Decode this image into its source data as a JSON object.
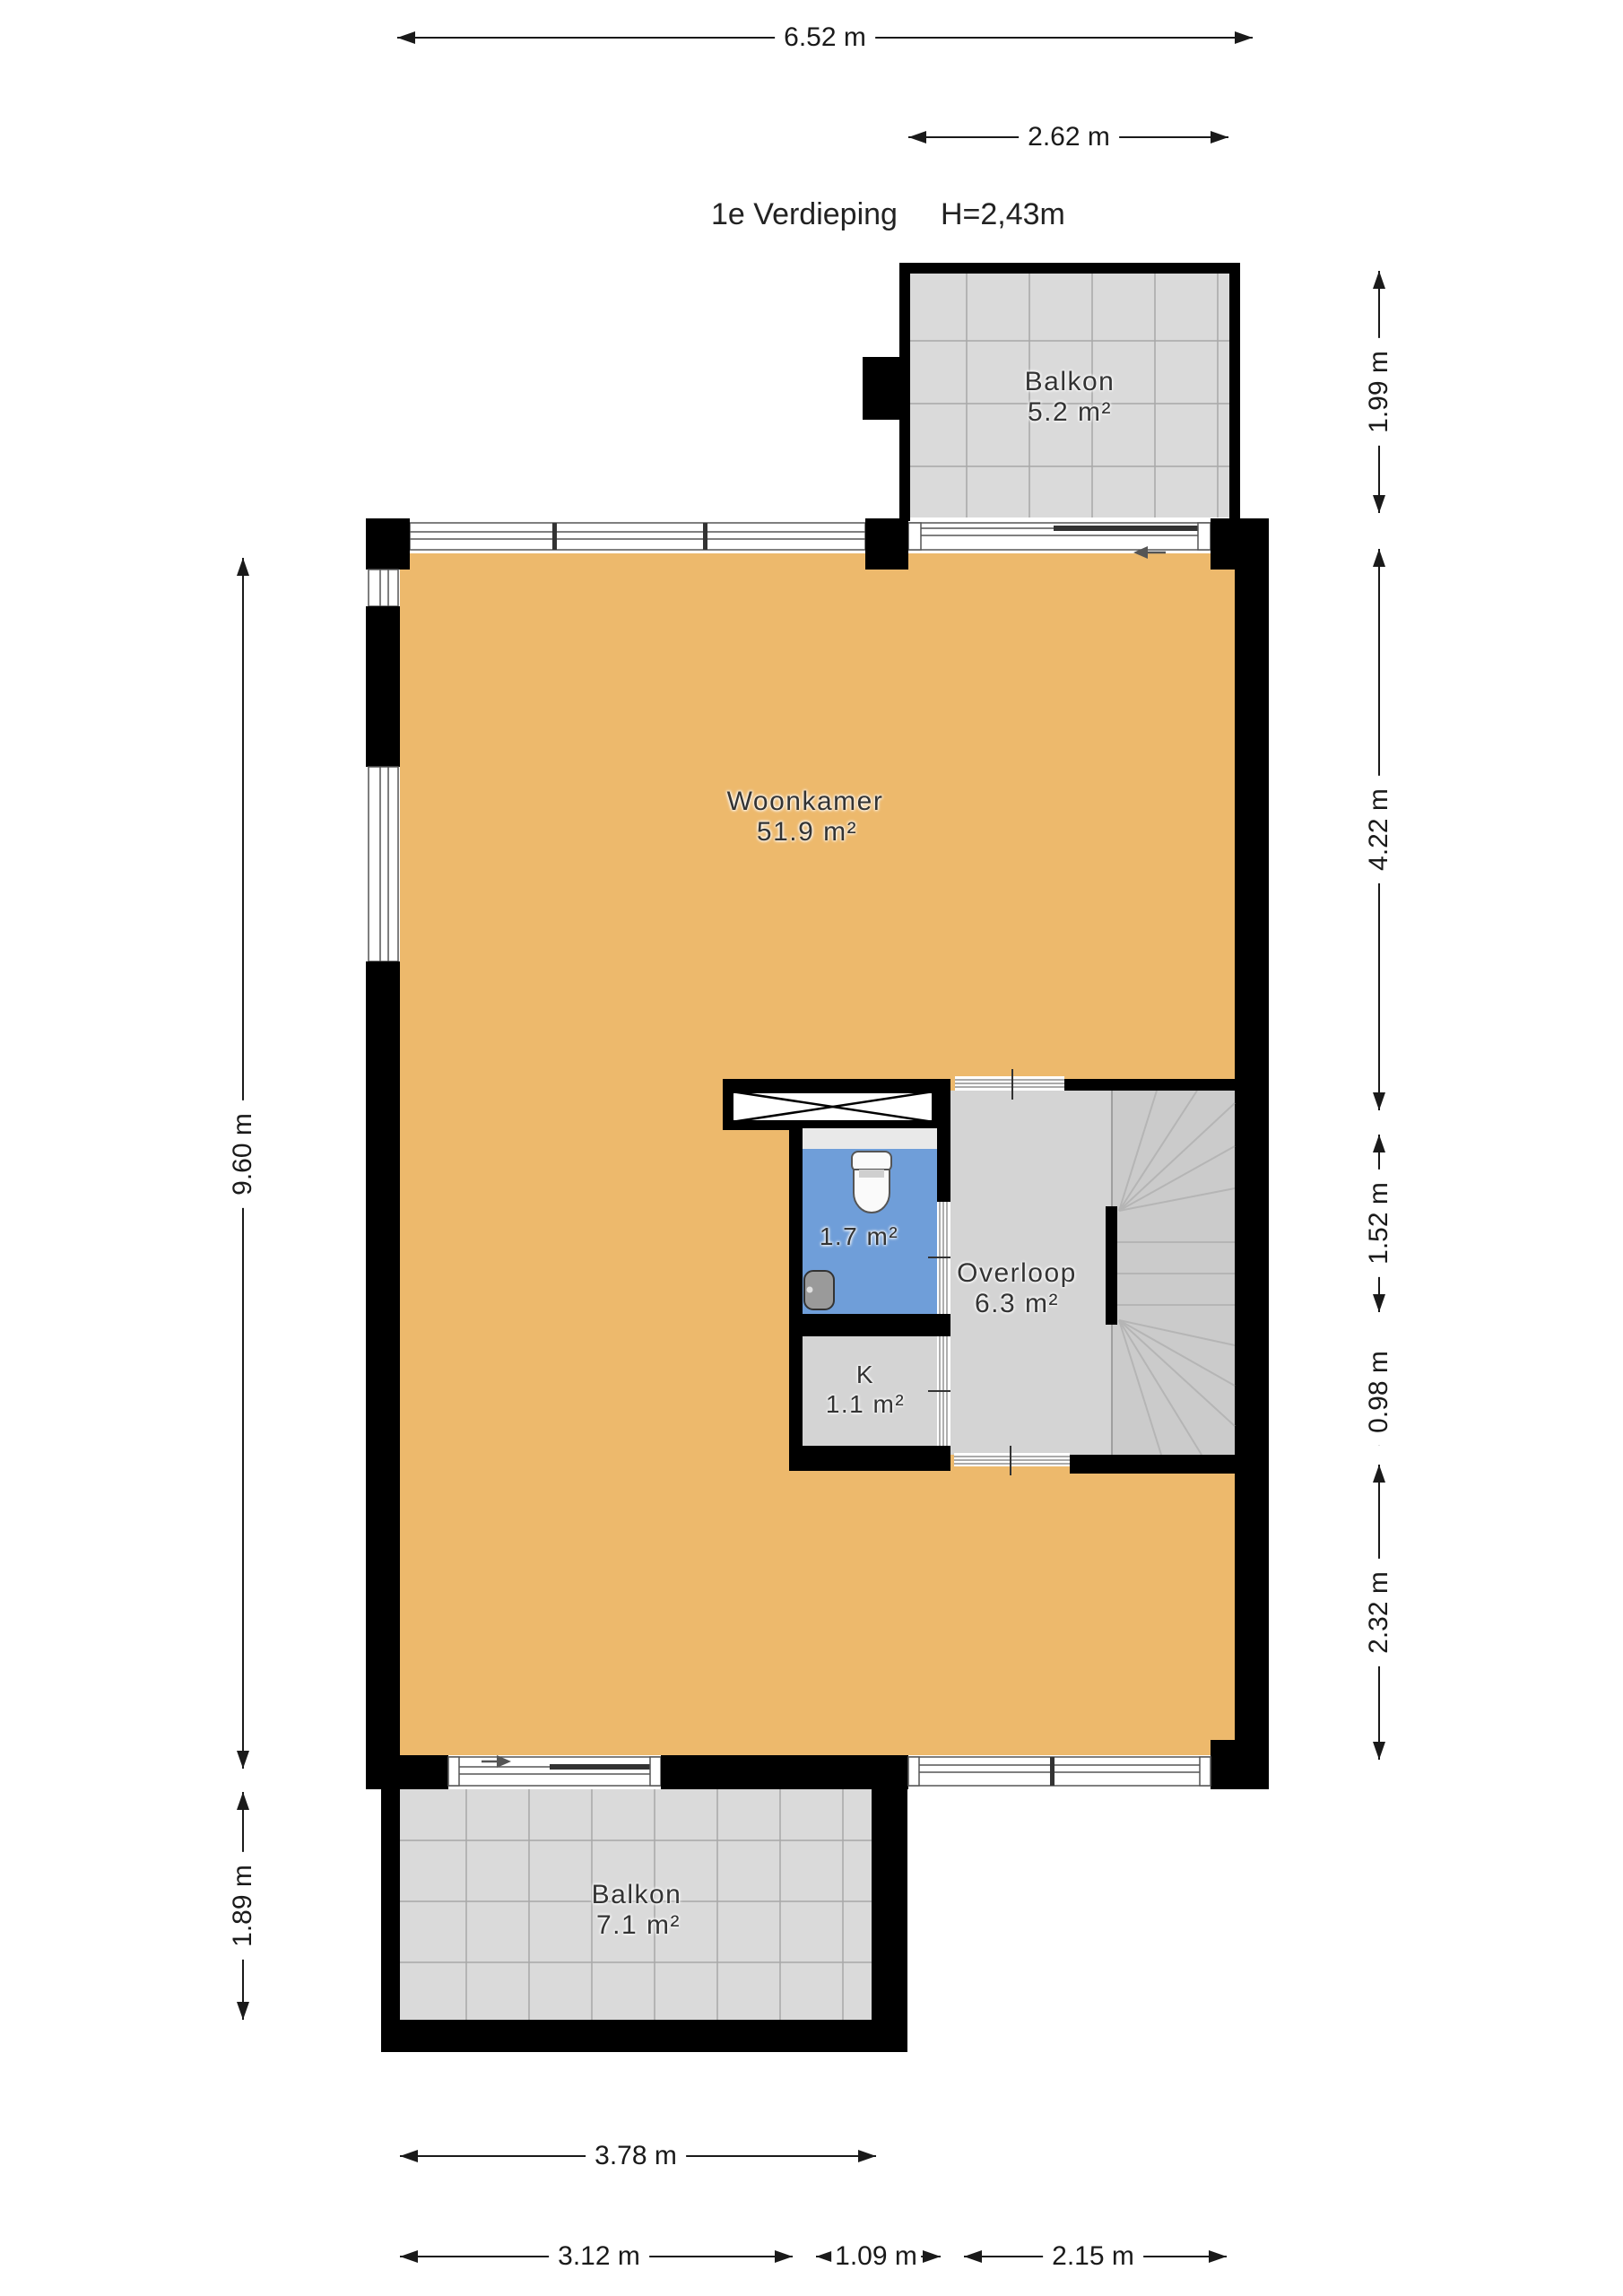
{
  "title": {
    "floor_label": "1e Verdieping",
    "ceiling_height": "H=2,43m"
  },
  "rooms": {
    "woonkamer": {
      "name": "Woonkamer",
      "area": "51.9 m²"
    },
    "balkon_top": {
      "name": "Balkon",
      "area": "5.2 m²"
    },
    "toilet": {
      "area": "1.7 m²"
    },
    "kast": {
      "name": "K",
      "area": "1.1 m²"
    },
    "overloop": {
      "name": "Overloop",
      "area": "6.3 m²"
    },
    "balkon_bottom": {
      "name": "Balkon",
      "area": "7.1 m²"
    }
  },
  "dimensions": {
    "top_width": "6.52 m",
    "balcony_top_width": "2.62 m",
    "left_height": "9.60 m",
    "balcony_bottom_height": "1.89 m",
    "right_balcony_top": "1.99 m",
    "right_woonkamer": "4.22 m",
    "right_toilet": "1.52 m",
    "right_kast": "0.98 m",
    "right_lower": "2.32 m",
    "balcony_bottom_width": "3.78 m",
    "bottom_left": "3.12 m",
    "bottom_middle": "1.09 m",
    "bottom_right": "2.15 m"
  },
  "colors": {
    "wall": "#000000",
    "floor": "#edb96c",
    "toilet": "#6f9ed9",
    "hall": "#d4d4d4",
    "stairs": "#cbcbcb",
    "balcony": "#dadada",
    "grid": "#a8a8a8",
    "tread": "#b5b5b5",
    "dim": "#1a1a1a"
  }
}
